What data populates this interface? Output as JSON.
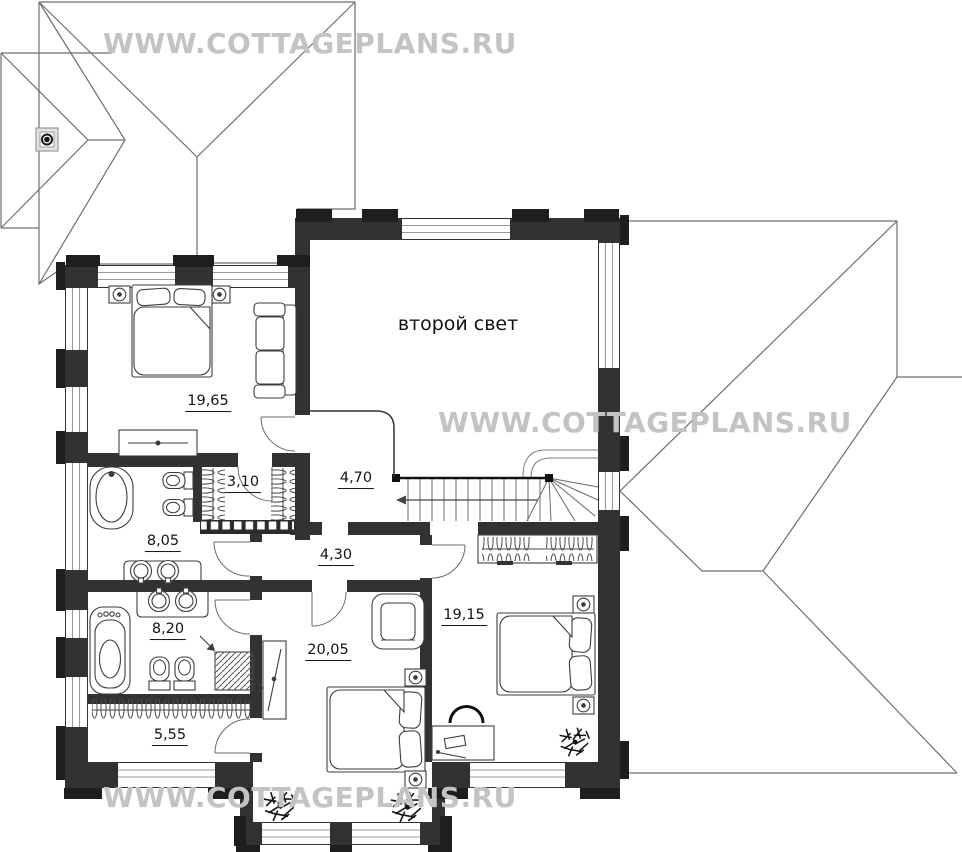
{
  "watermark": {
    "text": "WWW.COTTAGEPLANS.RU",
    "color": "#c3c3c3"
  },
  "labels": {
    "void": "второй свет",
    "bedroom_main": "19,65",
    "closet_small": "3,10",
    "stair_hall": "4,70",
    "bathroom_upper": "8,05",
    "corridor": "4,30",
    "bathroom_lower": "8,20",
    "bedroom_center": "20,05",
    "bedroom_right": "19,15",
    "closet_long": "5,55"
  },
  "colors": {
    "wall": "#323232",
    "pilaster": "#1e1e1e",
    "roof_line": "#6e6e6e",
    "furniture_line": "#3d3d3d",
    "label_text": "#141414"
  }
}
